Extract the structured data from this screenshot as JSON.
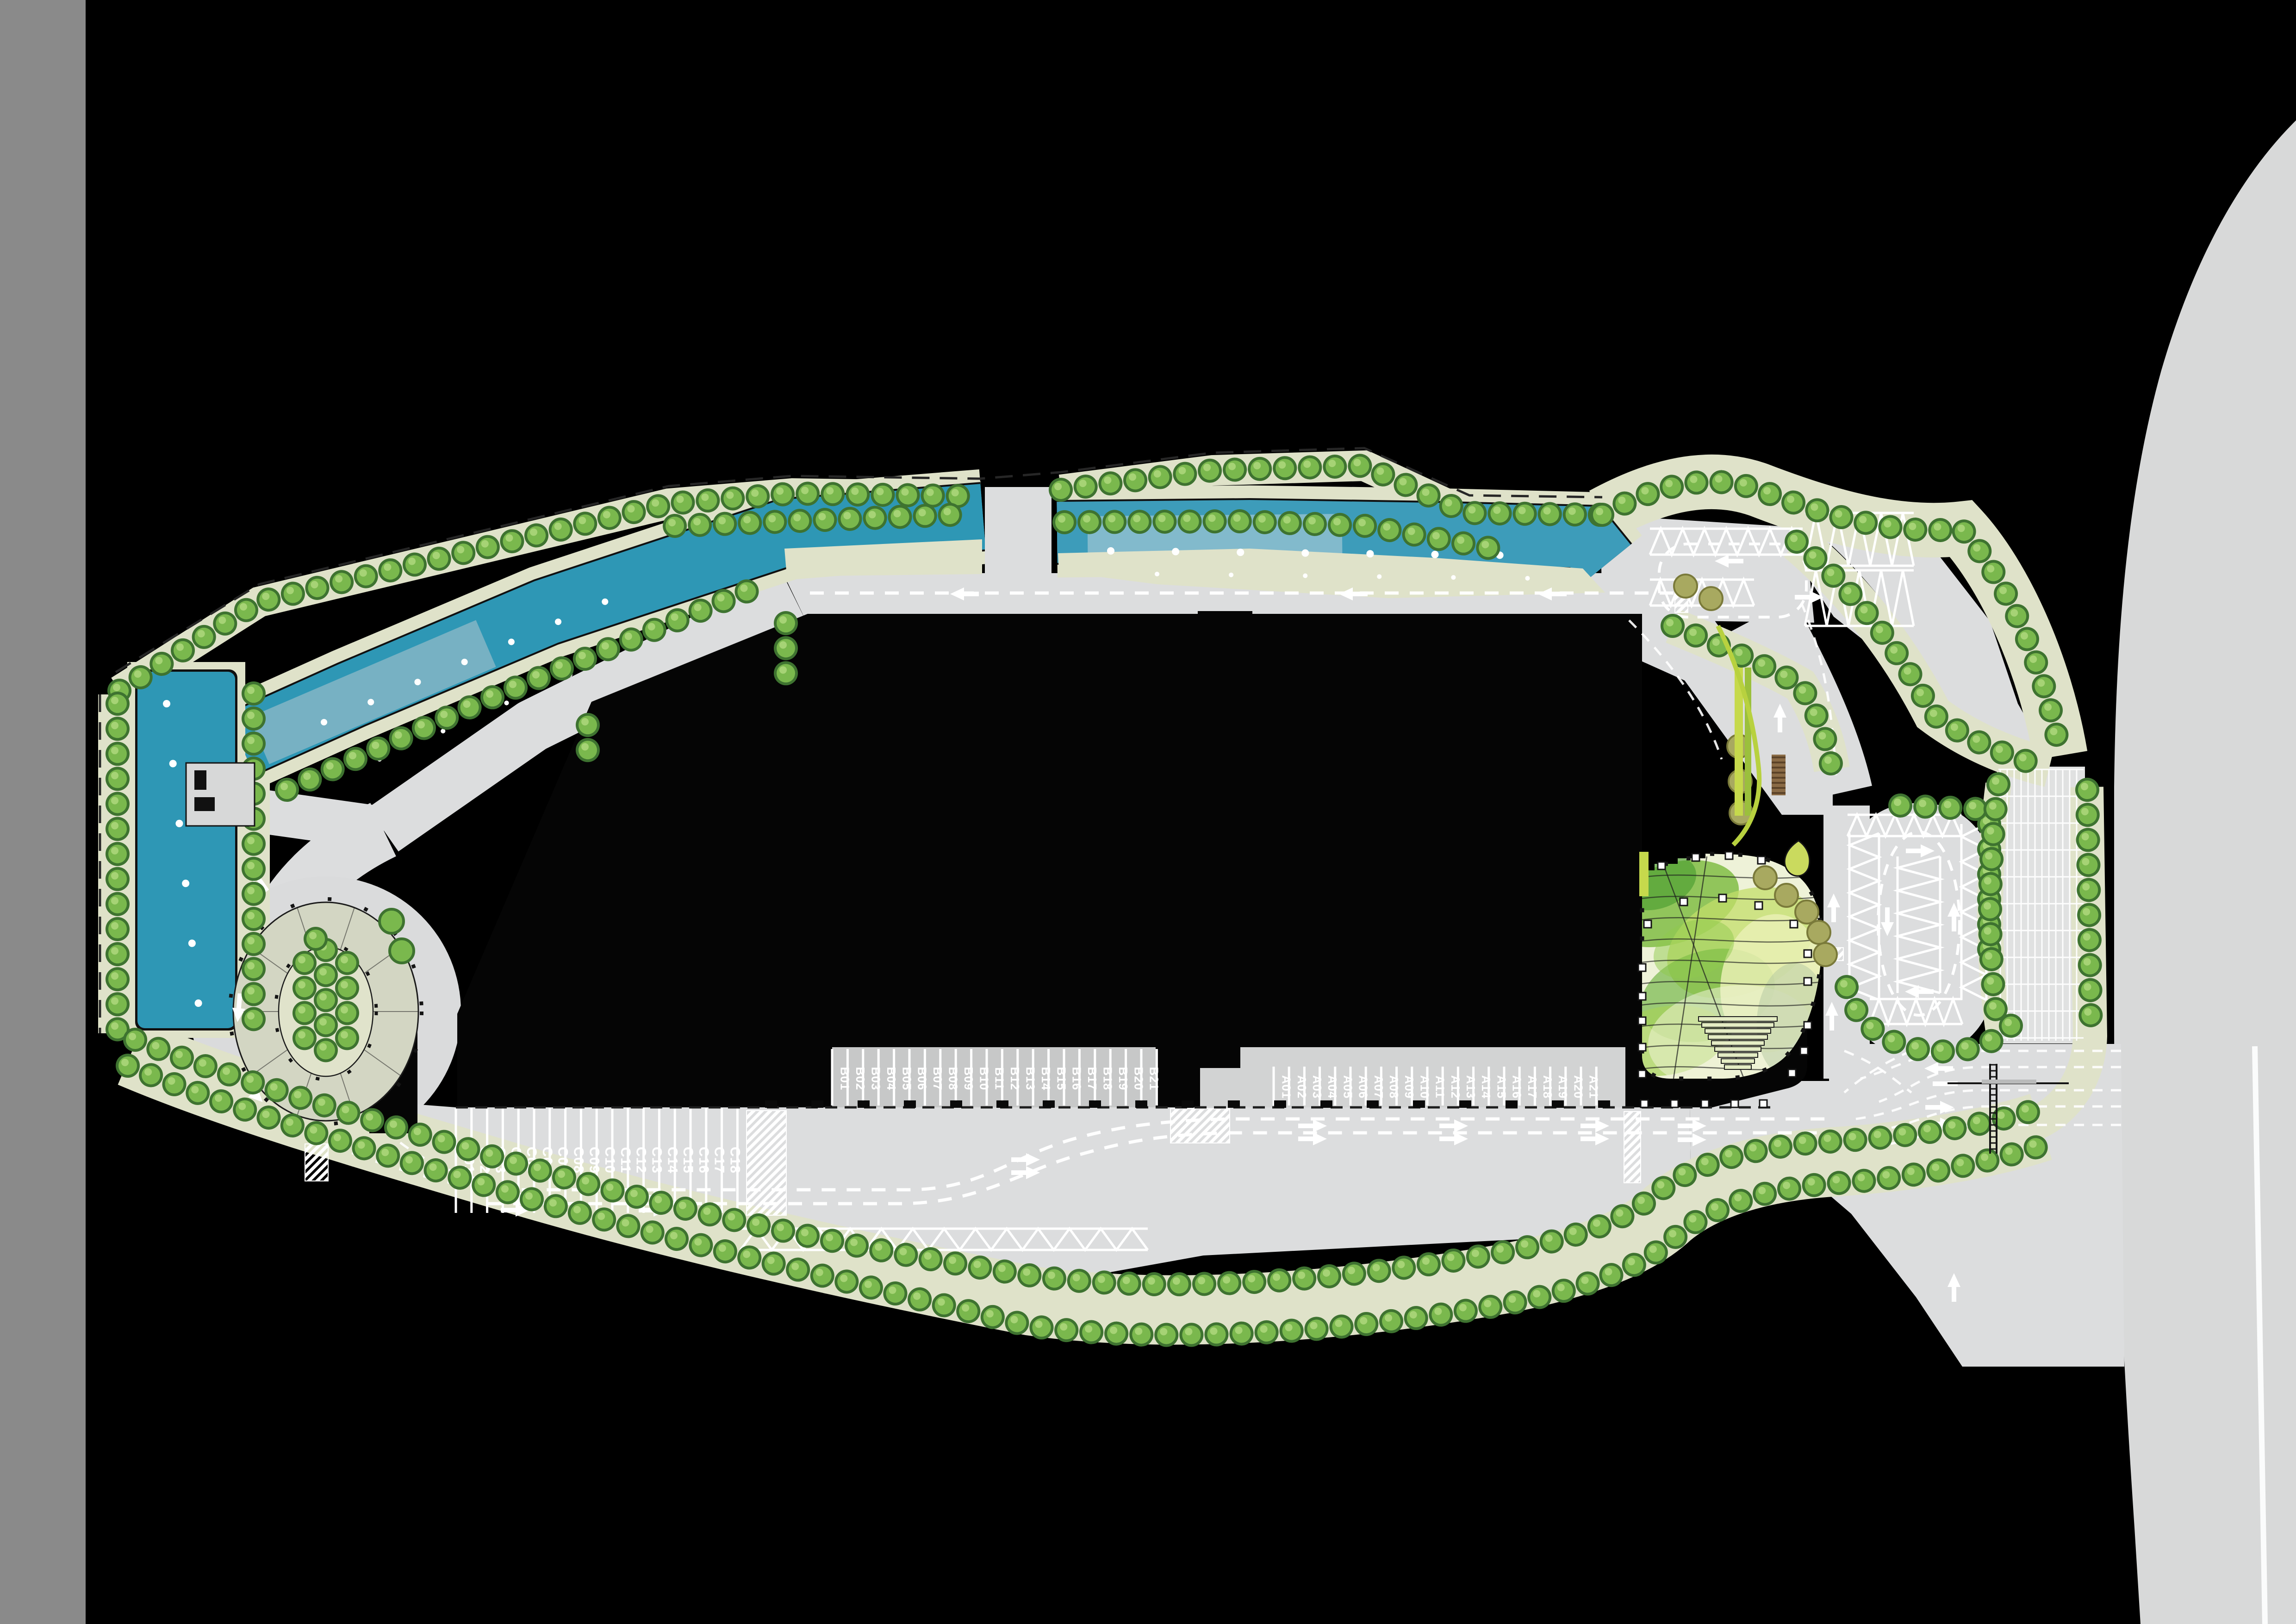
{
  "plan": {
    "type": "landscape-site-master-plan",
    "bay_groups": [
      {
        "id": "A",
        "labels": [
          "A01",
          "A02",
          "A03",
          "A04",
          "A05",
          "A06",
          "A07",
          "A08",
          "A09",
          "A10",
          "A11",
          "A12",
          "A13",
          "A14",
          "A15",
          "A16",
          "A17",
          "A18",
          "A19",
          "A20",
          "A21"
        ]
      },
      {
        "id": "B",
        "labels": [
          "B01",
          "B02",
          "B03",
          "B04",
          "B05",
          "B06",
          "B07",
          "B08",
          "B09",
          "B10",
          "B11",
          "B12",
          "B13",
          "B14",
          "B15",
          "B16",
          "B17",
          "B18",
          "B19",
          "B20",
          "B21"
        ]
      },
      {
        "id": "C",
        "labels": [
          "C01",
          "C02",
          "C03",
          "C04",
          "C05",
          "C06",
          "C07",
          "C08",
          "C09",
          "C10",
          "C11",
          "C12",
          "C13",
          "C14",
          "C15",
          "C16",
          "C17",
          "C18"
        ]
      }
    ],
    "palette": {
      "background": "#000000",
      "left_frame_gray": "#8a8a8a",
      "site_road": "#dcddde",
      "perimeter_highway": "#d8d9d9",
      "bus_apron_dark": "#c7c8c8",
      "bus_apron_light": "#d2d3d3",
      "parking_grid_bg": "#e0e1e1",
      "landscape_tan": "#dfe2c9",
      "water_deep_teal": "#2e97b5",
      "water_light": "#a9c3cd",
      "tree_outline_green": "#3e7330",
      "tree_body_green": "#7ab84d",
      "tree_highlight_green": "#a6d375",
      "olive_tree": "#a8a960",
      "lime_hedge": "#c6d94c",
      "leaf_plaza_greens": [
        "#79b93c",
        "#c3de69",
        "#62ad34",
        "#e9f0b4",
        "#a5d159"
      ],
      "oval_plaza_paving": "#d3d6c3",
      "oval_plaza_inner": "#e0e3cb",
      "road_marking_white": "#ffffff",
      "outline_black": "#141414",
      "pergola_wood": "#8a6b46"
    },
    "icons": {
      "lane-direction-arrow": "filled white arrow (tail + triangle head)",
      "tree-marker": "round green canopy dot",
      "bollard-marker": "small white square"
    }
  }
}
